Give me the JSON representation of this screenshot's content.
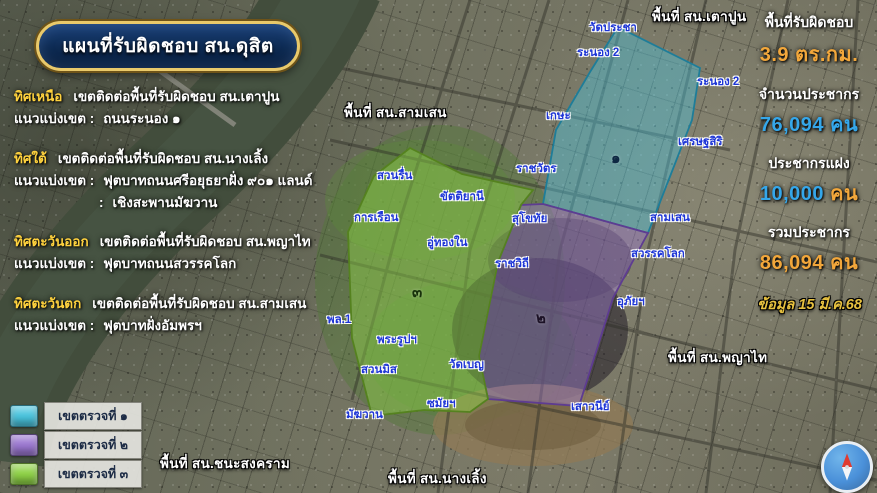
{
  "title": {
    "text": "แผนที่รับผิดชอบ สน.ดุสิต"
  },
  "info": {
    "blocks": [
      {
        "direction": "ทิศเหนือ",
        "desc": "เขตติดต่อพื้นที่รับผิดชอบ สน.เตาปูน",
        "boundary_label": "แนวแบ่งเขต :",
        "boundary": "ถนนระนอง ๑"
      },
      {
        "direction": "ทิศใต้",
        "desc": "เขตติดต่อพื้นที่รับผิดชอบ สน.นางเลิ้ง",
        "boundary_label": "แนวแบ่งเขต :",
        "boundary": "ฟุตบาทถนนศรีอยุธยาฝั่ง ๙๐๑ แลนด์",
        "boundary2_label": ":",
        "boundary2": "เชิงสะพานมัฆวาน"
      },
      {
        "direction": "ทิศตะวันออก",
        "desc": "เขตติดต่อพื้นที่รับผิดชอบ สน.พญาไท",
        "boundary_label": "แนวแบ่งเขต :",
        "boundary": "ฟุตบาทถนนสวรรคโลก"
      },
      {
        "direction": "ทิศตะวันตก",
        "desc": "เขตติดต่อพื้นที่รับผิดชอบ สน.สามเสน",
        "boundary_label": "แนวแบ่งเขต :",
        "boundary": "ฟุตบาทฝั่งอัมพรฯ"
      }
    ]
  },
  "stats": {
    "items": [
      {
        "label": "พื้นที่รับผิดชอบ",
        "value": "3.9 ตร.กม.",
        "color": "#f2a73b"
      },
      {
        "label": "จำนวนประชากร",
        "value": "76,094  คน",
        "color": "#35a7ea"
      },
      {
        "label": "ประชากรแฝง",
        "value": "10,000",
        "value_color": "#35a7ea",
        "unit": " คน",
        "unit_color": "#f2a73b"
      },
      {
        "label": "รวมประชากร",
        "value": "86,094 คน",
        "color": "#f2a73b"
      }
    ],
    "date": "ข้อมูล 15 มี.ค.68",
    "date_color": "#e7c13f"
  },
  "map": {
    "zones": [
      {
        "id": "zone-1",
        "label": "เขตตรวจที่ ๑",
        "color": "#49c4de",
        "stroke": "#1e7d99"
      },
      {
        "id": "zone-2",
        "label": "เขตตรวจที่ ๒",
        "color": "#9b77d1",
        "stroke": "#5e3c91"
      },
      {
        "id": "zone-3",
        "label": "เขตตรวจที่ ๓",
        "color": "#8ed246",
        "stroke": "#55821f"
      }
    ],
    "labels": [
      {
        "text": "พื้นที่ สน.เตาปูน",
        "type": "area",
        "x": 652,
        "y": 5
      },
      {
        "text": "พื้นที่ สน.สามเสน",
        "type": "area",
        "x": 344,
        "y": 101
      },
      {
        "text": "พื้นที่ สน.พญาไท",
        "type": "area",
        "x": 668,
        "y": 346
      },
      {
        "text": "พื้นที่ สน.ชนะสงคราม",
        "type": "area",
        "x": 160,
        "y": 452
      },
      {
        "text": "พื้นที่ สน.นางเลิ้ง",
        "type": "area",
        "x": 388,
        "y": 467
      },
      {
        "text": "วัดประชา",
        "type": "poi",
        "x": 589,
        "y": 19
      },
      {
        "text": "ระนอง 2",
        "type": "poi",
        "x": 577,
        "y": 44
      },
      {
        "text": "ระนอง 2",
        "type": "poi",
        "x": 697,
        "y": 73
      },
      {
        "text": "เกษะ",
        "type": "poi",
        "x": 546,
        "y": 107
      },
      {
        "text": "เศรษฐสิริ",
        "type": "poi",
        "x": 678,
        "y": 133
      },
      {
        "text": "ราชวัตร",
        "type": "poi",
        "x": 516,
        "y": 160
      },
      {
        "text": "สวนรื่น",
        "type": "poi",
        "x": 377,
        "y": 167
      },
      {
        "text": "ขัตติยานี",
        "type": "poi",
        "x": 440,
        "y": 188
      },
      {
        "text": "การเรือน",
        "type": "poi",
        "x": 354,
        "y": 209
      },
      {
        "text": "สุโขทัย",
        "type": "poi",
        "x": 512,
        "y": 210
      },
      {
        "text": "สามเสน",
        "type": "poi",
        "x": 650,
        "y": 209
      },
      {
        "text": "อู่ทองใน",
        "type": "poi",
        "x": 427,
        "y": 234
      },
      {
        "text": "สวรรคโลก",
        "type": "poi",
        "x": 631,
        "y": 245
      },
      {
        "text": "ราชวิถี",
        "type": "poi",
        "x": 495,
        "y": 255
      },
      {
        "text": "อุภัยฯ",
        "type": "poi",
        "x": 617,
        "y": 293
      },
      {
        "text": "พล.1",
        "type": "poi",
        "x": 327,
        "y": 311
      },
      {
        "text": "พระรูปฯ",
        "type": "poi",
        "x": 377,
        "y": 331
      },
      {
        "text": "สวนมิส",
        "type": "poi",
        "x": 361,
        "y": 361
      },
      {
        "text": "วัดเบญ",
        "type": "poi",
        "x": 449,
        "y": 356
      },
      {
        "text": "ซมัยฯ",
        "type": "poi",
        "x": 427,
        "y": 395
      },
      {
        "text": "มัฆวาน",
        "type": "poi",
        "x": 346,
        "y": 406
      },
      {
        "text": "เสาวนีย์",
        "type": "poi",
        "x": 571,
        "y": 398
      },
      {
        "text": "๑",
        "type": "zone",
        "x": 611,
        "y": 146,
        "color": "#0e2742"
      },
      {
        "text": "๒",
        "type": "zone",
        "x": 536,
        "y": 306,
        "color": "#1c1226"
      },
      {
        "text": "๓",
        "type": "zone",
        "x": 412,
        "y": 280,
        "color": "#17300a"
      }
    ]
  }
}
